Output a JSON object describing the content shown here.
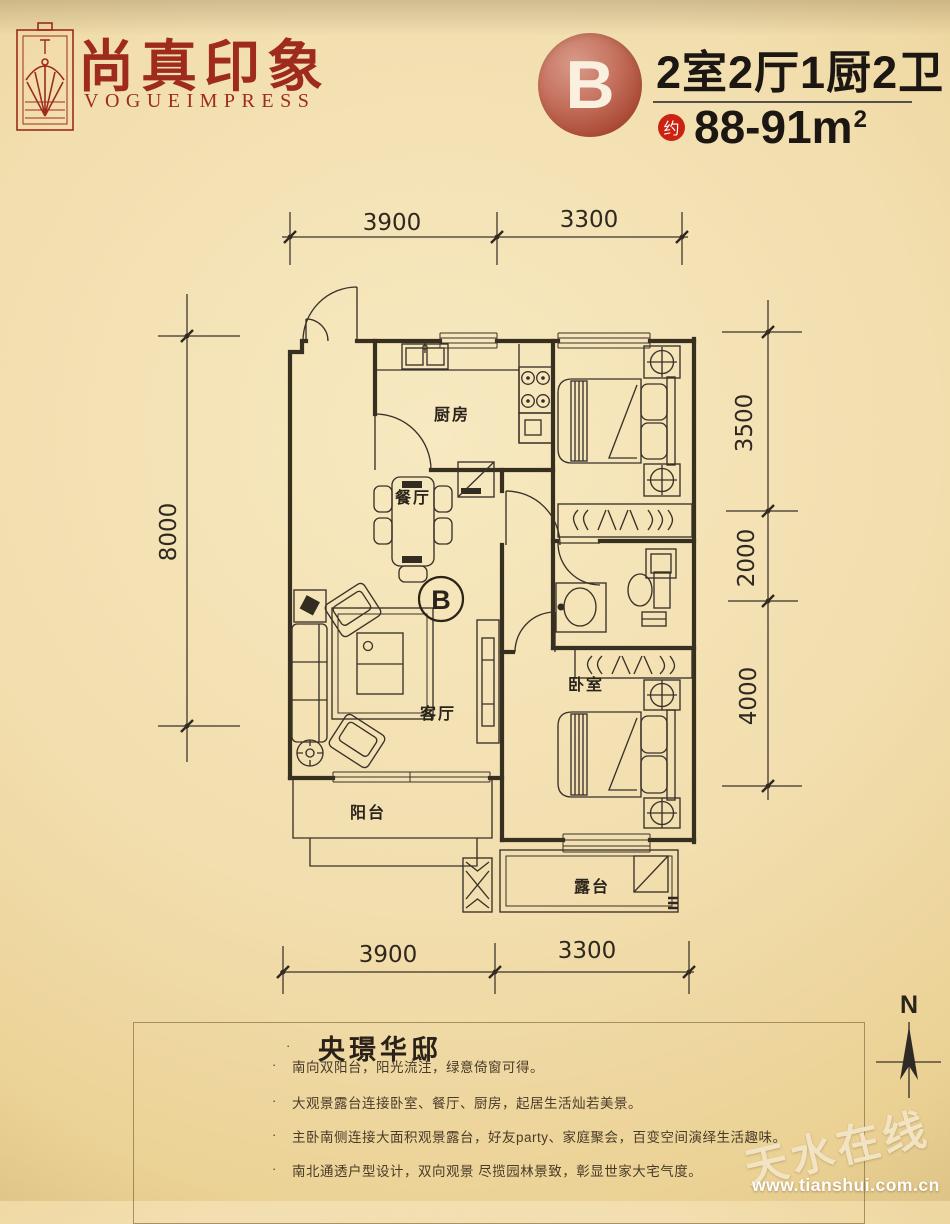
{
  "brand": {
    "name_cn": "尚真印象",
    "name_en": "VOGUEIMPRESS"
  },
  "unit": {
    "letter": "B",
    "layout": "2室2厅1厨2卫",
    "approx_badge": "约",
    "area": "88-91",
    "area_unit": "m",
    "area_unit_sup": "2"
  },
  "plan": {
    "marker": "B",
    "rooms": {
      "kitchen": "厨房",
      "dining": "餐厅",
      "living": "客厅",
      "bedroom": "卧室",
      "balcony": "阳台",
      "terrace": "露台"
    },
    "dims": {
      "top": [
        "3900",
        "3300"
      ],
      "bottom": [
        "3900",
        "3300"
      ],
      "left": [
        "8000"
      ],
      "right": [
        "3500",
        "2000",
        "4000"
      ]
    },
    "compass": "N"
  },
  "description": {
    "bullet_dot": "·",
    "title": "央璟华邸",
    "bullets": [
      "南向双阳台，阳光流注，绿意倚窗可得。",
      "大观景露台连接卧室、餐厅、厨房，起居生活灿若美景。",
      "主卧南侧连接大面积观景露台，好友party、家庭聚会，百变空间演绎生活趣味。",
      "南北通透户型设计，双向观景 尽揽园林景致，彰显世家大宅气度。"
    ]
  },
  "watermark": {
    "site_name": "天水在线",
    "site_url": "www.tianshui.com.cn"
  },
  "colors": {
    "brand_red": "#9e2b1d",
    "badge_red": "#cc2212",
    "ink": "#3a3129",
    "paper": "#f2deae"
  }
}
